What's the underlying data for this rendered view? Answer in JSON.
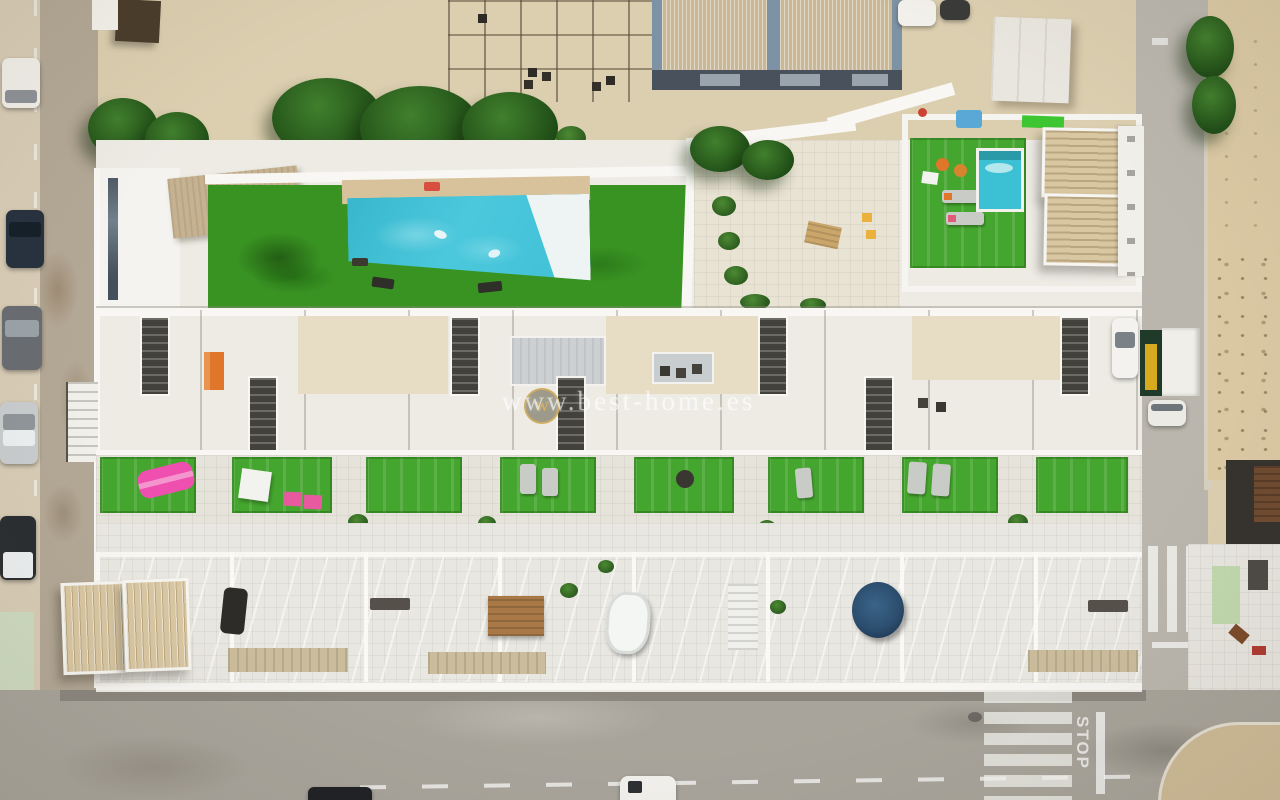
{
  "watermark": {
    "text": "www.best-home.es",
    "logo_letter": "w"
  },
  "road_markings": {
    "stop_text": "STOP"
  },
  "palette": {
    "plaza": "#dccfb0",
    "sand": "#dbc9a4",
    "sidewalk": "#d8ccb6",
    "road_left": "#b3a795",
    "road_main": "#a8a49b",
    "road_right": "#bab6ae",
    "complex_white": "#edebe4",
    "wall_white": "#f8f7f3",
    "paving": "#e6e3da",
    "tile_white": "#e9e7e1",
    "patio_beige": "#e7dcc4",
    "lawn_green": "#399322",
    "turf_green": "#44a62e",
    "pool_water": "#3fc0d6",
    "pool_shallow": "#eef3f3",
    "tree_green": "#2d5e20",
    "stair_dark": "#43413b",
    "pergola_beige": "#d9c7a2",
    "roof_tan": "#c6b291",
    "frame_blue": "#7d92a5",
    "roof_stripe": "#c9b795",
    "building_base": "#49525c",
    "truck_green": "#1f3a28",
    "truck_yellow": "#d6a91f",
    "accent_orange": "#e0762a",
    "accent_pink": "#ef4fae",
    "wood_brown": "#a87947",
    "spa_blue": "#2c4e6e",
    "marking_white": "#f5f3ec"
  }
}
